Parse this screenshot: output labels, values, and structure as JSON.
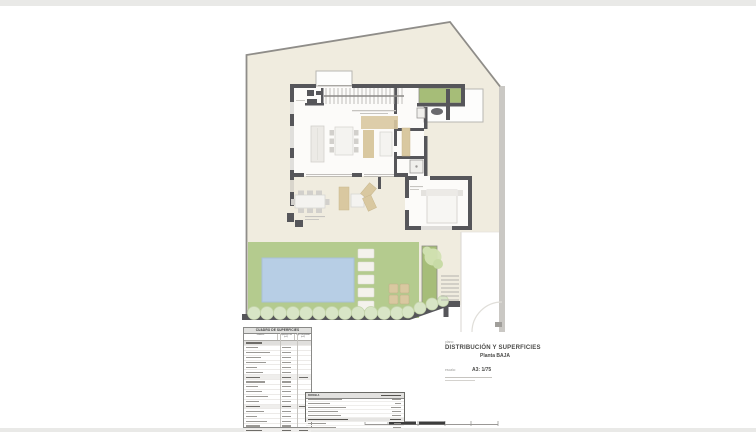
{
  "page": {
    "title_block": {
      "plano_label": "plano:",
      "title": "DISTRIBUCIÓN Y SUPERFICIES",
      "subtitle": "Planta BAJA",
      "escala_label": "escala:",
      "scale_value": "A3: 1/75"
    },
    "surfaces_table": {
      "title": "CUADRO DE SUPERFICIES",
      "col_room": "estancia",
      "col_util": "superficie útil (m2)",
      "col_built": "sup. construida (m2)",
      "rows": [
        {
          "t": "s",
          "w": 16
        },
        {
          "t": "d",
          "w": 12
        },
        {
          "t": "d",
          "w": 24
        },
        {
          "t": "d",
          "w": 15
        },
        {
          "t": "d",
          "w": 20
        },
        {
          "t": "d",
          "w": 11
        },
        {
          "t": "d",
          "w": 17
        },
        {
          "t": "t",
          "w": 14
        },
        {
          "t": "d",
          "w": 19
        },
        {
          "t": "d",
          "w": 12
        },
        {
          "t": "d",
          "w": 16
        },
        {
          "t": "d",
          "w": 22
        },
        {
          "t": "d",
          "w": 13
        },
        {
          "t": "t",
          "w": 14
        },
        {
          "t": "d",
          "w": 18
        },
        {
          "t": "d",
          "w": 11
        },
        {
          "t": "d",
          "w": 21
        },
        {
          "t": "d",
          "w": 14
        },
        {
          "t": "t",
          "w": 16
        },
        {
          "t": "s",
          "w": 20
        },
        {
          "t": "d",
          "w": 17
        },
        {
          "t": "d",
          "w": 12
        },
        {
          "t": "T",
          "w": 22
        }
      ]
    },
    "parcel_box": {
      "title": "PARCELA",
      "rows": [
        {
          "w": 34,
          "v": 9
        },
        {
          "w": 22,
          "v": 6
        },
        {
          "w": 38,
          "v": 10
        },
        {
          "w": 30,
          "v": 9
        },
        {
          "w": 33,
          "v": 9
        },
        {
          "t": "T",
          "w": 40,
          "v": 11
        },
        {
          "w": 18,
          "v": 7
        },
        {
          "w": 28,
          "v": 8
        }
      ]
    },
    "colors": {
      "plot_fill": "#f0ecdf",
      "wall": "#56565a",
      "boundary_line": "#8f8d89",
      "boundary_band": "#cac8c4",
      "lawn": "#b4cb8e",
      "pool": "#b7cee5",
      "planter": "#a6bd78",
      "hedge": "#d8e5c6",
      "furniture_tan": "#d9c8a0",
      "page_band": "#e9e9e7"
    }
  }
}
